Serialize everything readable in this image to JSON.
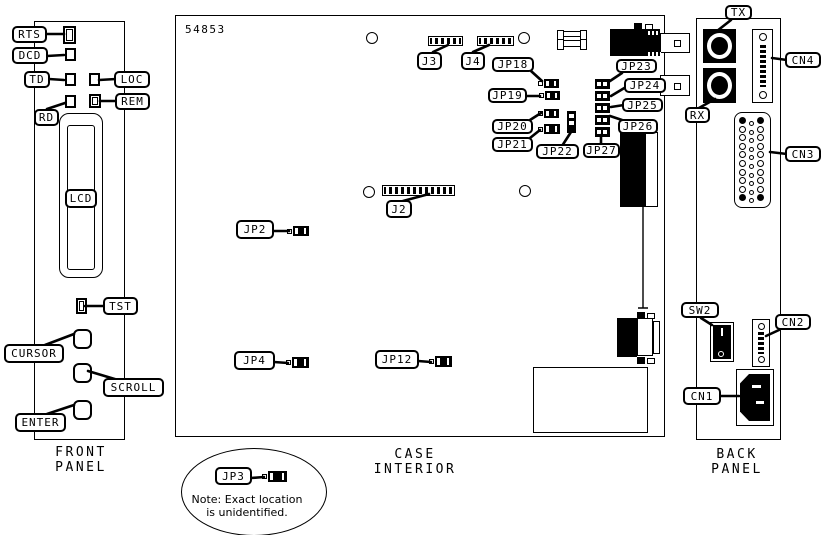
{
  "title": "Device panel layout diagram",
  "colors": {
    "ink": "#000000",
    "paper": "#ffffff"
  },
  "front_panel": {
    "caption": "FRONT PANEL"
  },
  "case_interior": {
    "caption": "CASE INTERIOR",
    "board_number": "54853"
  },
  "back_panel": {
    "caption": "BACK PANEL"
  },
  "note": {
    "text": "Note: Exact location\nis unidentified."
  },
  "callouts": {
    "rts": "RTS",
    "dcd": "DCD",
    "td": "TD",
    "rd": "RD",
    "loc": "LOC",
    "rem": "REM",
    "lcd": "LCD",
    "tst": "TST",
    "cursor": "CURSOR",
    "scroll": "SCROLL",
    "enter": "ENTER",
    "j3": "J3",
    "j4": "J4",
    "j2": "J2",
    "jp2": "JP2",
    "jp4": "JP4",
    "jp12": "JP12",
    "jp18": "JP18",
    "jp19": "JP19",
    "jp20": "JP20",
    "jp21": "JP21",
    "jp22": "JP22",
    "jp23": "JP23",
    "jp24": "JP24",
    "jp25": "JP25",
    "jp26": "JP26",
    "jp27": "JP27",
    "jp3": "JP3",
    "tx": "TX",
    "rx": "RX",
    "cn4": "CN4",
    "cn3": "CN3",
    "sw2": "SW2",
    "cn2": "CN2",
    "cn1": "CN1"
  }
}
